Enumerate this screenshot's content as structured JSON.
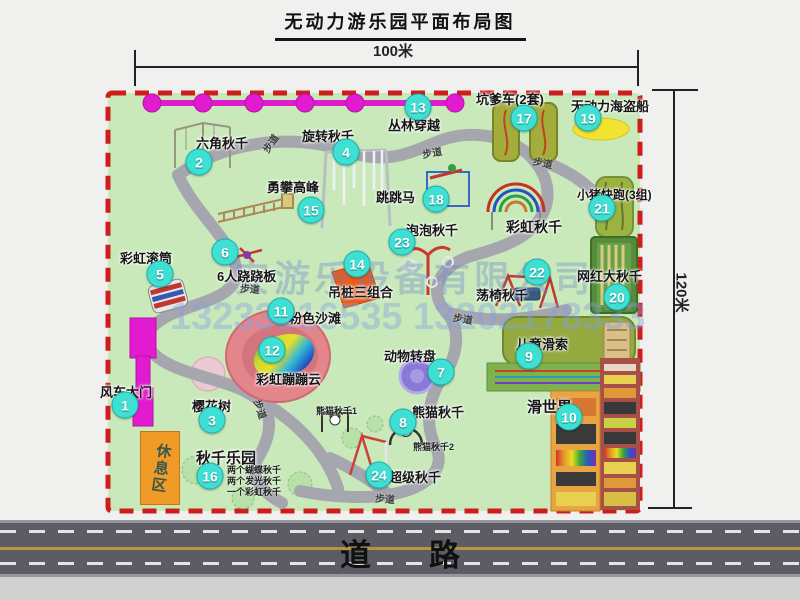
{
  "title": "无动力游乐园平面布局图",
  "dim_width": "100米",
  "dim_height": "120米",
  "road_label": "道路",
  "rest_area_label": "休息区",
  "walkway_label": "步道",
  "watermark": {
    "company": "安游乐设备有限公司",
    "phone": "13233816535 13202178333"
  },
  "colors": {
    "map_green": "#c9e9bb",
    "border_red": "#cf1d1d",
    "badge": "#3fe0d3",
    "road": "#5c5c64",
    "magenta": "#e31bd0",
    "orange": "#f09a28",
    "path_gray": "#a6a6ae"
  },
  "attractions": [
    {
      "num": "1",
      "name": "风车大门",
      "badge_x": 125,
      "badge_y": 405,
      "label_x": 100,
      "label_y": 382
    },
    {
      "num": "2",
      "name": "六角秋千",
      "badge_x": 199,
      "badge_y": 162,
      "label_x": 196,
      "label_y": 133
    },
    {
      "num": "3",
      "name": "樱花树",
      "badge_x": 212,
      "badge_y": 420,
      "label_x": 192,
      "label_y": 396
    },
    {
      "num": "4",
      "name": "旋转秋千",
      "badge_x": 346,
      "badge_y": 152,
      "label_x": 302,
      "label_y": 126
    },
    {
      "num": "5",
      "name": "彩虹滚筒",
      "badge_x": 160,
      "badge_y": 274,
      "label_x": 120,
      "label_y": 248
    },
    {
      "num": "6",
      "name": "6人跷跷板",
      "badge_x": 225,
      "badge_y": 252,
      "label_x": 217,
      "label_y": 266
    },
    {
      "num": "7",
      "name": "动物转盘",
      "badge_x": 441,
      "badge_y": 372,
      "label_x": 384,
      "label_y": 346
    },
    {
      "num": "8",
      "name": "熊猫秋千",
      "badge_x": 403,
      "badge_y": 422,
      "label_x": 412,
      "label_y": 402
    },
    {
      "num": "9",
      "name": "儿童滑索",
      "badge_x": 529,
      "badge_y": 356,
      "label_x": 516,
      "label_y": 334
    },
    {
      "num": "10",
      "name": "滑世界",
      "badge_x": 569,
      "badge_y": 417,
      "label_x": 527,
      "label_y": 396,
      "label_size": 15
    },
    {
      "num": "11",
      "name": "粉色沙滩",
      "badge_x": 281,
      "badge_y": 311,
      "label_x": 289,
      "label_y": 308
    },
    {
      "num": "12",
      "name": "彩虹蹦蹦云",
      "badge_x": 272,
      "badge_y": 350,
      "label_x": 256,
      "label_y": 369
    },
    {
      "num": "13",
      "name": "丛林穿越",
      "badge_x": 418,
      "badge_y": 107,
      "label_x": 388,
      "label_y": 115
    },
    {
      "num": "14",
      "name": "吊桩三组合",
      "badge_x": 357,
      "badge_y": 264,
      "label_x": 328,
      "label_y": 282
    },
    {
      "num": "15",
      "name": "勇攀高峰",
      "badge_x": 311,
      "badge_y": 210,
      "label_x": 267,
      "label_y": 177
    },
    {
      "num": "16",
      "name": "秋千乐园",
      "badge_x": 210,
      "badge_y": 476,
      "label_x": 196,
      "label_y": 447,
      "label_size": 15
    },
    {
      "num": "17",
      "name": "坑爹车(2套)",
      "badge_x": 524,
      "badge_y": 118,
      "label_x": 476,
      "label_y": 89
    },
    {
      "num": "18",
      "name": "跳跳马",
      "badge_x": 436,
      "badge_y": 199,
      "label_x": 376,
      "label_y": 187
    },
    {
      "num": "19",
      "name": "无动力海盗船",
      "badge_x": 588,
      "badge_y": 118,
      "label_x": 571,
      "label_y": 96
    },
    {
      "num": "20",
      "name": "网红大秋千",
      "badge_x": 617,
      "badge_y": 297,
      "label_x": 577,
      "label_y": 266
    },
    {
      "num": "21",
      "name": "小猪快跑(3组)",
      "badge_x": 602,
      "badge_y": 208,
      "label_x": 577,
      "label_y": 186,
      "label_size": 12
    },
    {
      "num": "22",
      "name": "荡椅秋千",
      "badge_x": 537,
      "badge_y": 272,
      "label_x": 476,
      "label_y": 285
    },
    {
      "num": "23",
      "name": "泡泡秋千",
      "badge_x": 402,
      "badge_y": 242,
      "label_x": 406,
      "label_y": 220
    },
    {
      "num": "24",
      "name": "超级秋千",
      "badge_x": 379,
      "badge_y": 475,
      "label_x": 389,
      "label_y": 467
    }
  ],
  "extra_labels": [
    {
      "text": "彩虹秋千",
      "x": 506,
      "y": 217,
      "size": 14
    },
    {
      "text": "熊猫秋千1",
      "x": 316,
      "y": 404,
      "size": 9
    },
    {
      "text": "熊猫秋千2",
      "x": 413,
      "y": 440,
      "size": 9
    }
  ],
  "swing_park_notes": [
    "两个蝴蝶秋千",
    "两个发光秋千",
    "一个彩虹秋千"
  ],
  "walkway_marks": [
    {
      "x": 270,
      "y": 143,
      "rot": -55
    },
    {
      "x": 432,
      "y": 152,
      "rot": -10
    },
    {
      "x": 543,
      "y": 162,
      "rot": 12
    },
    {
      "x": 250,
      "y": 288,
      "rot": 4
    },
    {
      "x": 463,
      "y": 318,
      "rot": 10
    },
    {
      "x": 261,
      "y": 409,
      "rot": 72
    },
    {
      "x": 385,
      "y": 498,
      "rot": 4
    }
  ]
}
